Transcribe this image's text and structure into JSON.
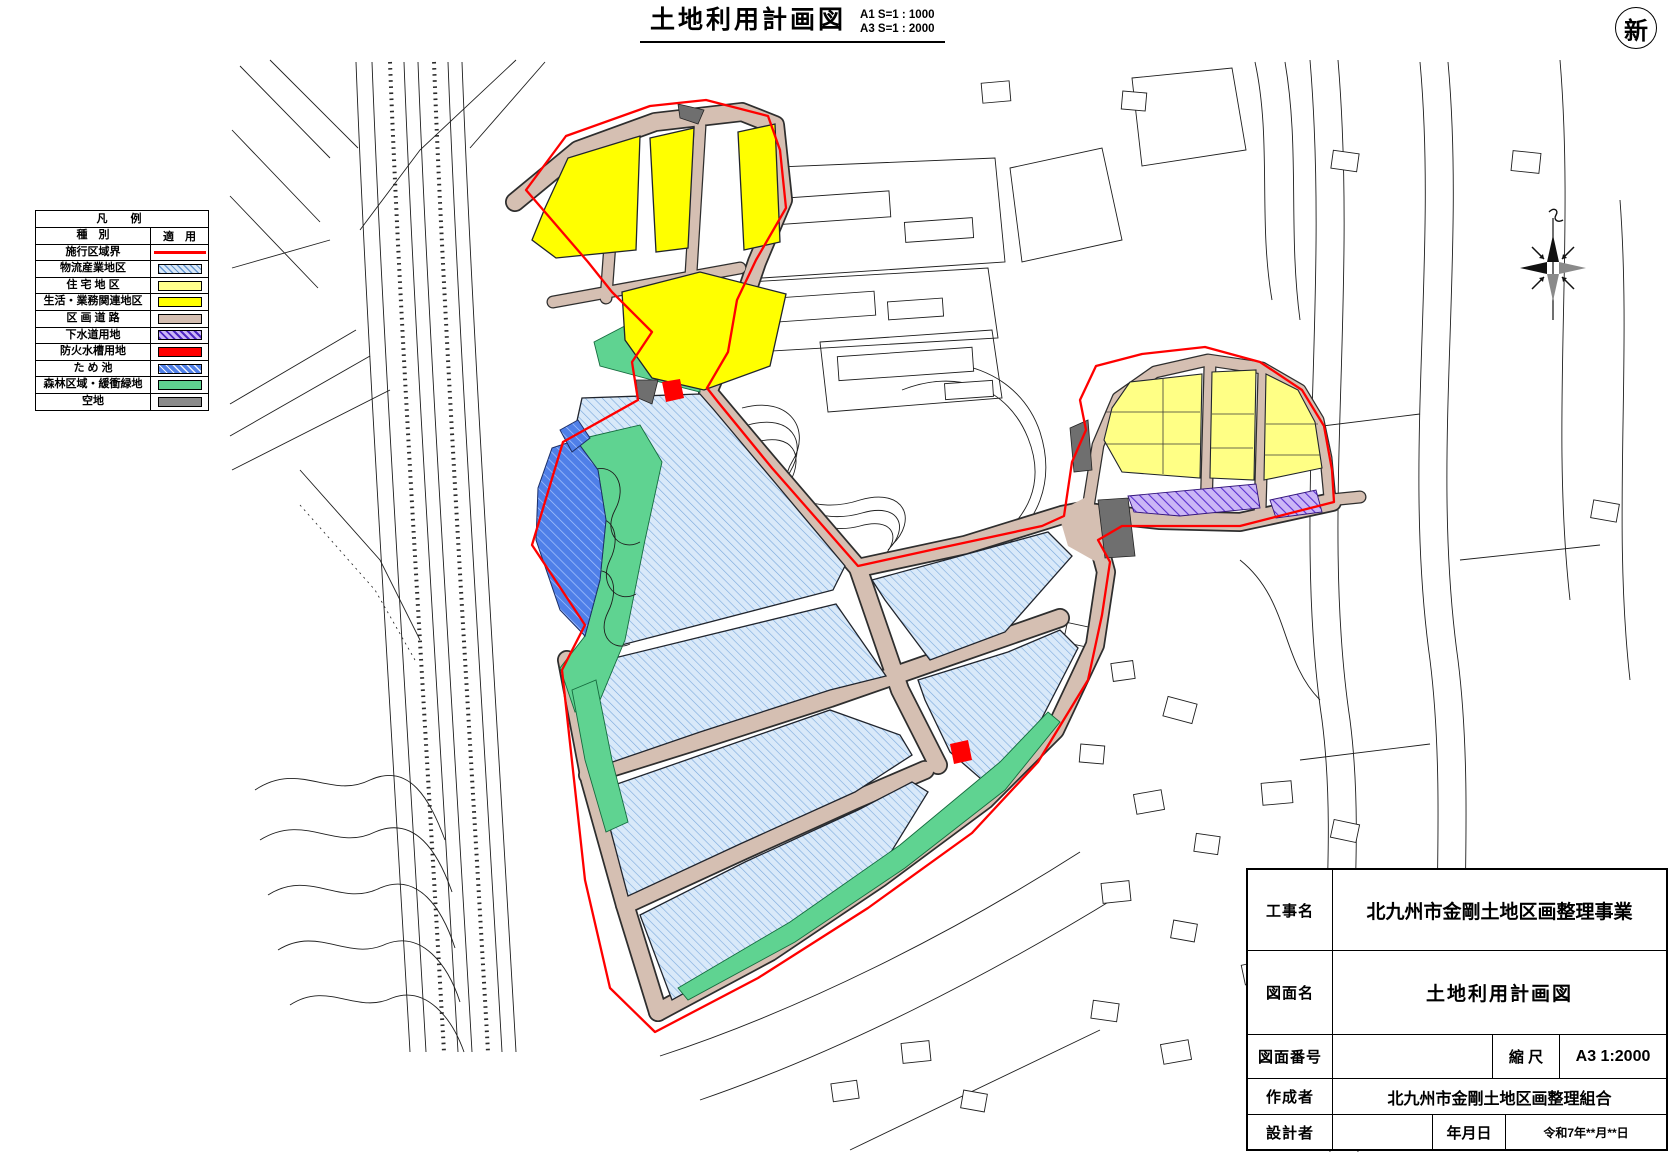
{
  "title": {
    "text": "土地利用計画図",
    "scale_a1": "A1 S=1 : 1000",
    "scale_a3": "A3 S=1 : 2000"
  },
  "stamp": {
    "text": "新"
  },
  "legend": {
    "title": "凡　例",
    "col_type": "種　別",
    "col_use": "適　用",
    "rows": [
      {
        "label": "施行区域界",
        "style": "line",
        "color": "#ff0000"
      },
      {
        "label": "物流産業地区",
        "style": "hatch",
        "color": "#d9e9f9"
      },
      {
        "label": "住 宅 地 区",
        "style": "fill",
        "color": "#ffff8c"
      },
      {
        "label": "生活・業務関連地区",
        "style": "fill",
        "color": "#ffff00"
      },
      {
        "label": "区 画 道 路",
        "style": "fill",
        "color": "#d5bfb2"
      },
      {
        "label": "下水道用地",
        "style": "hatch",
        "color": "#cbb6f6"
      },
      {
        "label": "防火水槽用地",
        "style": "fill",
        "color": "#ff0000"
      },
      {
        "label": "た め 池",
        "style": "hatch",
        "color": "#4f7fe8"
      },
      {
        "label": "森林区域・緩衝緑地",
        "style": "fill",
        "color": "#5fd391"
      },
      {
        "label": "空地",
        "style": "fill",
        "color": "#8c8c8c"
      }
    ]
  },
  "title_block": {
    "rows": [
      {
        "label": "工事名",
        "value": "北九州市金剛土地区画整理事業"
      },
      {
        "label": "図面名",
        "value": "土地利用計画図"
      },
      {
        "label": "図面番号",
        "value": "",
        "sub_label": "縮 尺",
        "sub_value": "A3 1:2000"
      },
      {
        "label": "作成者",
        "value": "北九州市金剛土地区画整理組合"
      },
      {
        "label": "設計者",
        "value": "",
        "sub_label": "年月日",
        "sub_value": "令和7年**月**日"
      }
    ]
  }
}
